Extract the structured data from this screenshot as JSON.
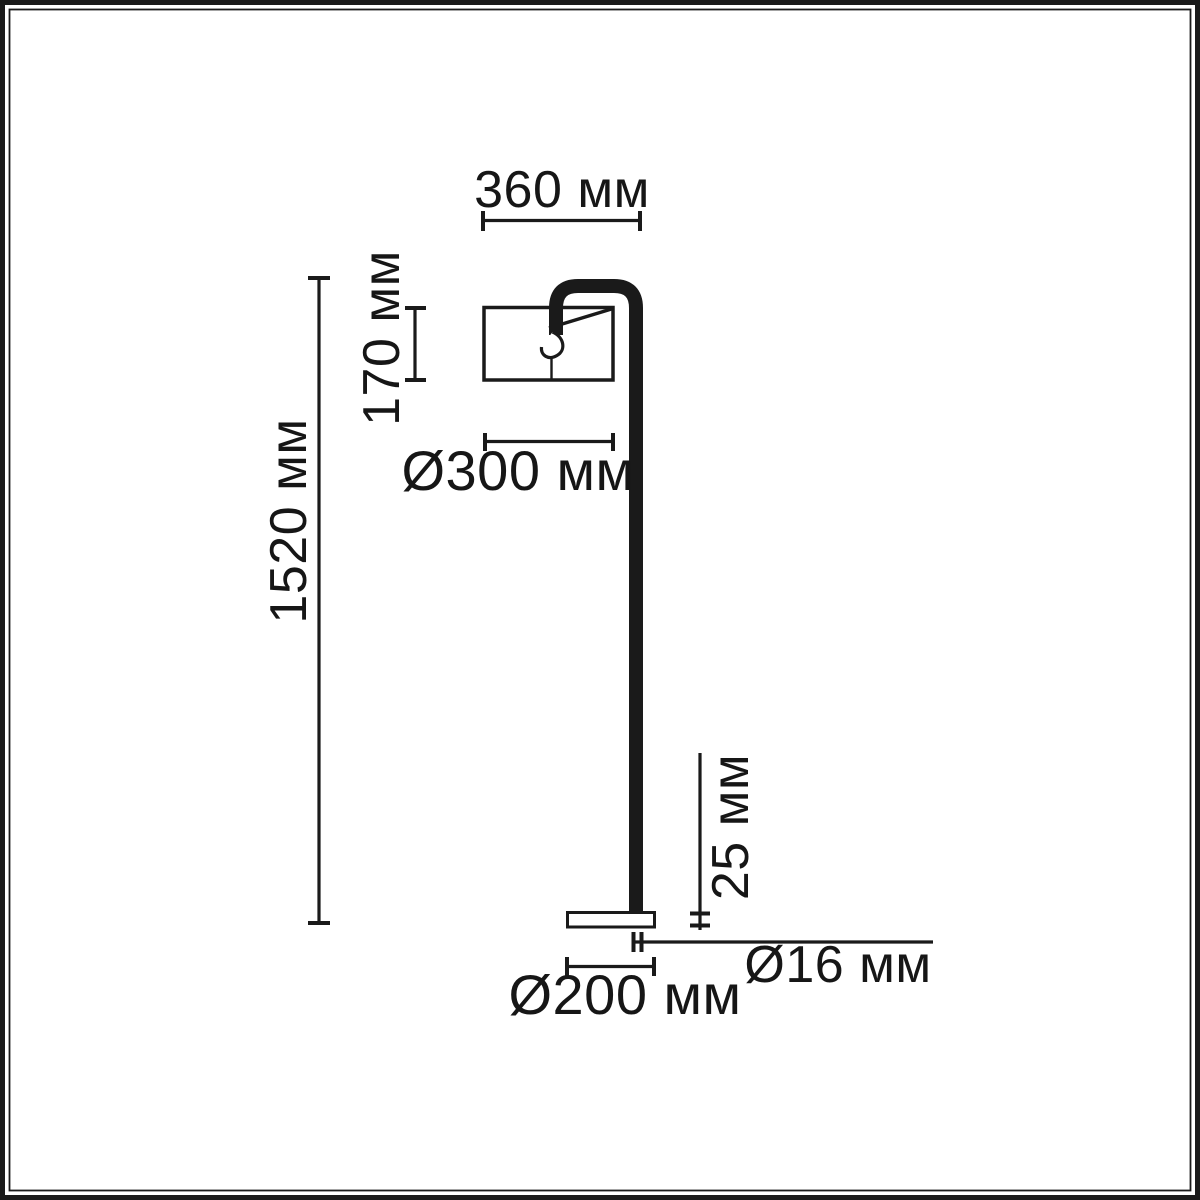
{
  "diagram": {
    "kind": "floor-lamp dimension drawing",
    "labels": {
      "top_width": "360 мм",
      "shade_height": "170 мм",
      "shade_diameter": "Ø300 мм",
      "total_height": "1520 мм",
      "base_thickness": "25 мм",
      "pole_diameter": "Ø16 мм",
      "base_diameter": "Ø200 мм"
    },
    "colors": {
      "ink": "#1a1a1a",
      "background": "#ffffff"
    }
  }
}
